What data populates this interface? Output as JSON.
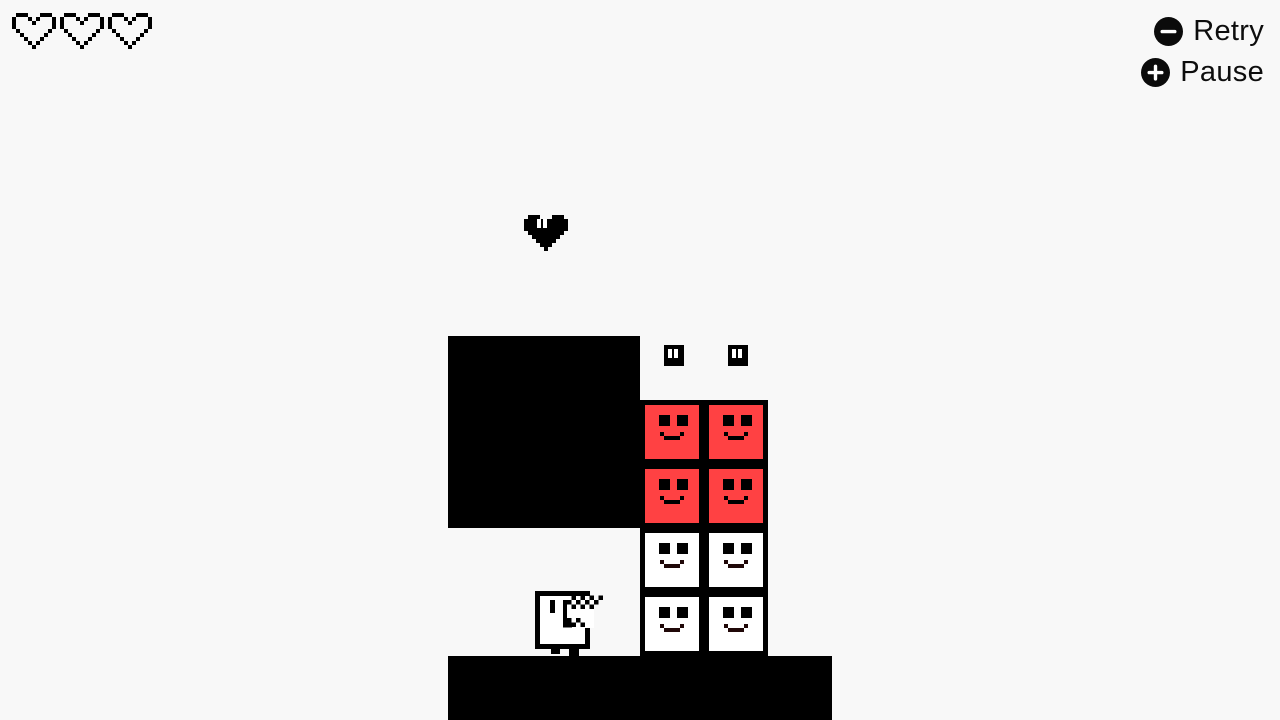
{
  "hud": {
    "lives": {
      "count": 3,
      "icon": "heart-outline-icon"
    },
    "controls": [
      {
        "id": "retry",
        "icon": "minus-circle-icon",
        "label": "Retry"
      },
      {
        "id": "pause",
        "icon": "plus-circle-icon",
        "label": "Pause"
      }
    ]
  },
  "board": {
    "tile_size": 64,
    "walls": [
      {
        "name": "wall-block",
        "x": 448,
        "y": 336,
        "w": 192,
        "h": 192
      },
      {
        "name": "ground-platform",
        "x": 448,
        "y": 656,
        "w": 384,
        "h": 64
      }
    ],
    "blocks": [
      {
        "x": 640,
        "y": 400,
        "variant": "red"
      },
      {
        "x": 704,
        "y": 400,
        "variant": "red"
      },
      {
        "x": 640,
        "y": 464,
        "variant": "red"
      },
      {
        "x": 704,
        "y": 464,
        "variant": "red"
      },
      {
        "x": 640,
        "y": 528,
        "variant": "white"
      },
      {
        "x": 704,
        "y": 528,
        "variant": "white"
      },
      {
        "x": 640,
        "y": 592,
        "variant": "white"
      },
      {
        "x": 704,
        "y": 592,
        "variant": "white"
      }
    ],
    "floating_faces": [
      {
        "x": 664,
        "y": 345
      },
      {
        "x": 728,
        "y": 345
      }
    ],
    "heart_pickup": {
      "x": 524,
      "y": 215
    },
    "player": {
      "x": 533,
      "y": 588
    }
  },
  "colors": {
    "background": "#f8f8f8",
    "ink": "#000000",
    "block_red": "#ff4143",
    "block_white": "#ffffff",
    "white_block_smile": "#200808",
    "text": "#0d0d0d"
  }
}
